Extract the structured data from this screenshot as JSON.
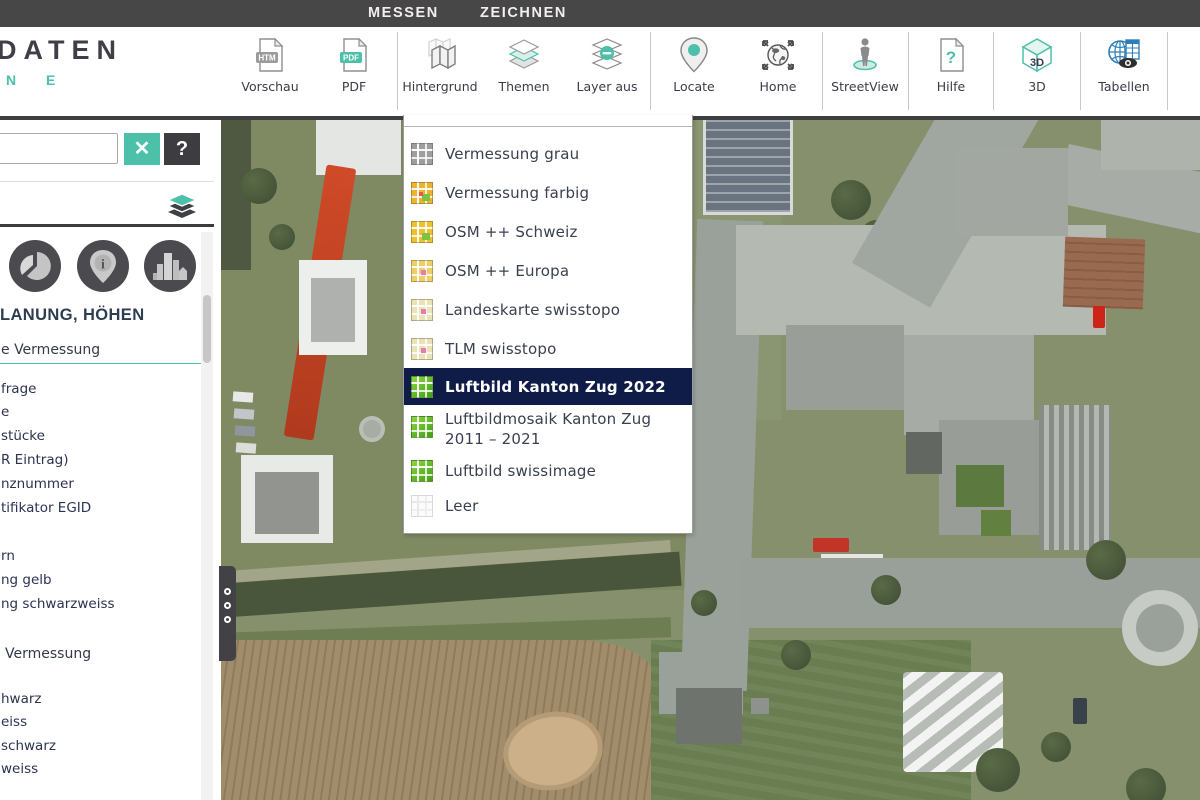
{
  "colors": {
    "accent": "#4cc0a9",
    "tab_bar": "#474747",
    "menu_highlight_bg": "#0f1c47",
    "dark_strip": "#3f3f42"
  },
  "tabs": {
    "items": [
      {
        "label": "HOME",
        "active": true
      },
      {
        "label": "MESSEN",
        "active": false
      },
      {
        "label": "ZEICHNEN",
        "active": false
      }
    ]
  },
  "logo": {
    "line1": "DATEN",
    "line2": "N E"
  },
  "toolbar": {
    "buttons": [
      {
        "label": "Vorschau",
        "icon": "document-htm-icon",
        "badge": "HTM"
      },
      {
        "label": "PDF",
        "icon": "document-pdf-icon",
        "badge": "PDF"
      },
      {
        "label": "Hintergrund",
        "icon": "folded-map-icon"
      },
      {
        "label": "Themen",
        "icon": "layer-stack-icon"
      },
      {
        "label": "Layer aus",
        "icon": "layers-off-icon"
      },
      {
        "label": "Locate",
        "icon": "map-pin-icon"
      },
      {
        "label": "Home",
        "icon": "globe-arrows-icon"
      },
      {
        "label": "StreetView",
        "icon": "pegman-icon"
      },
      {
        "label": "Hilfe",
        "icon": "document-question-icon",
        "badge": "?"
      },
      {
        "label": "3D",
        "icon": "cube-3d-icon",
        "badge": "3D"
      },
      {
        "label": "Tabellen",
        "icon": "globe-table-eye-icon"
      }
    ]
  },
  "sidebar": {
    "search": {
      "value": "",
      "clear_icon": "✕",
      "help_icon": "?"
    },
    "section_title": "LANUNG, HÖHEN",
    "groups": [
      {
        "header": "e Vermessung",
        "items": [
          "frage",
          "e",
          "stücke",
          "R Eintrag)",
          "nznummer",
          "tifikator EGID",
          "rn",
          "ng gelb",
          "ng schwarzweiss"
        ]
      },
      {
        "header": "Vermessung",
        "items": [
          "hwarz",
          "eiss",
          "schwarz",
          "weiss"
        ]
      }
    ]
  },
  "background_menu": {
    "items": [
      {
        "label": "Vermessung grau",
        "icon": "map-tile-gray-icon"
      },
      {
        "label": "Vermessung farbig",
        "icon": "map-tile-orange-icon"
      },
      {
        "label": "OSM ++ Schweiz",
        "icon": "map-tile-yellow-icon"
      },
      {
        "label": "OSM ++ Europa",
        "icon": "map-tile-lightyellow-icon"
      },
      {
        "label": "Landeskarte swisstopo",
        "icon": "map-tile-pale-icon"
      },
      {
        "label": "TLM swisstopo",
        "icon": "map-tile-pale-icon"
      },
      {
        "label": "Luftbild Kanton Zug 2022",
        "icon": "map-tile-green-icon",
        "highlighted": true
      },
      {
        "label": "Luftbildmosaik Kanton Zug",
        "label2": "2011 – 2021",
        "icon": "map-tile-green-icon"
      },
      {
        "label": "Luftbild swissimage",
        "icon": "map-tile-green-icon"
      },
      {
        "label": "Leer",
        "icon": "map-tile-blank-icon"
      }
    ]
  }
}
